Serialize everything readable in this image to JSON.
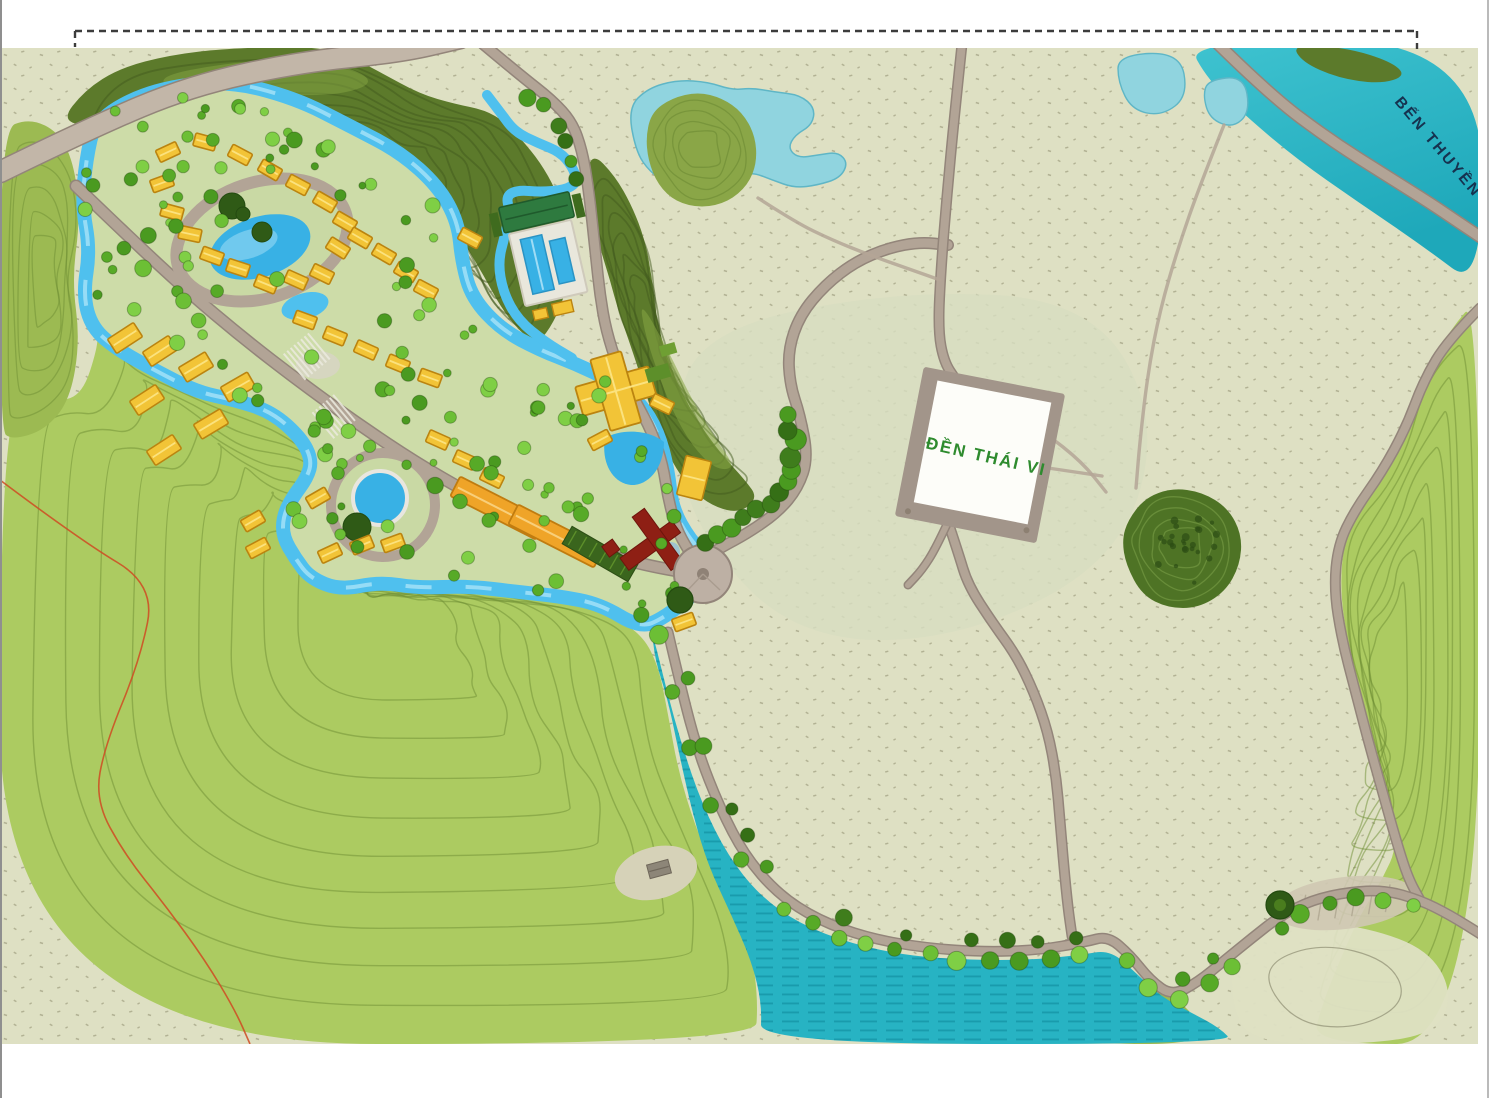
{
  "page": {
    "background": "#ffffff",
    "content_type": "resort master plan rendering (site plan map)"
  },
  "frame": {
    "style": "dashed top border with corner ticks"
  },
  "map": {
    "labels": {
      "den_thai_vi": "ĐỀN THÁI VI",
      "ben_thuyen": "BẾN THUYỀN"
    },
    "features": {
      "temple_parcel": "white tilted rectangular parcel with gray road border",
      "boat_dock_river": "teal river across top-right corner",
      "resort_village": "villa cluster with lagoon, pools and winding blue stream, top-left",
      "paddy_fields": "pale speckled fields across center and right",
      "hills": "green contoured karst hills left, bottom and right"
    }
  },
  "colors": {
    "white": "#ffffff",
    "paddy": "#dee0c3",
    "paddy_speck": "#8e8c6d",
    "river": "#2cb9c8",
    "river_deep": "#17a3b4",
    "water": "#27b3c3",
    "water_hatch": "#0c8496",
    "stream": "#4fc0ee",
    "stream_light": "#a8e2f8",
    "pond_pale": "#90d4df",
    "pond_edge": "#5fb6c6",
    "island": "#8aa647",
    "island_dark": "#6d8a34",
    "hill_light": "#accb61",
    "hill_mid": "#9cba52",
    "hill_contour": "#6d8d33",
    "ridge": "#5c7a2b",
    "ridge_dark": "#42591d",
    "ridge_light": "#86a544",
    "forest": "#4e7325",
    "forest_light": "#7da24a",
    "road_casing": "#93857a",
    "road": "#b2a496",
    "road_light": "#c2b6a8",
    "path_thin": "#b4a696",
    "villa": "#f2c437",
    "villa_edge": "#bb8410",
    "villa_ridge": "#fbe27e",
    "orange": "#efa428",
    "orange_edge": "#c07c10",
    "red_building": "#8e1f14",
    "red_edge": "#6d150c",
    "deck": "#e9e7dc",
    "deck_edge": "#cfcabb",
    "club_green": "#2e7a3f",
    "club_dark": "#1f5a2c",
    "hedge": "#3f6b1e",
    "parking": "#3a651d",
    "parking_stripe": "#5d8f2a",
    "lawn": "#5d8f2a",
    "parcel_fill": "#fdfdf9",
    "parcel_border": "#a2958a",
    "plaza": "#bdb0a4",
    "pool": "#38b1e5",
    "pool_light": "#9fdcf5",
    "pool_rim": "#e8e6df",
    "tree_dark": "#2f5a16",
    "tree1": "#6cbf35",
    "tree2": "#57aa27",
    "tree3": "#7fcf45",
    "tree4": "#4a9a20",
    "tree_row1": "#3f7d1c",
    "tree_row2": "#356f16",
    "gravel": "#cfc8b3",
    "boundary_line": "#cf4a22",
    "label_green": "#2e8b2e",
    "label_navy": "#16324f",
    "frame_line": "#3c3c3c",
    "page_edge": "#8f8f8f"
  }
}
